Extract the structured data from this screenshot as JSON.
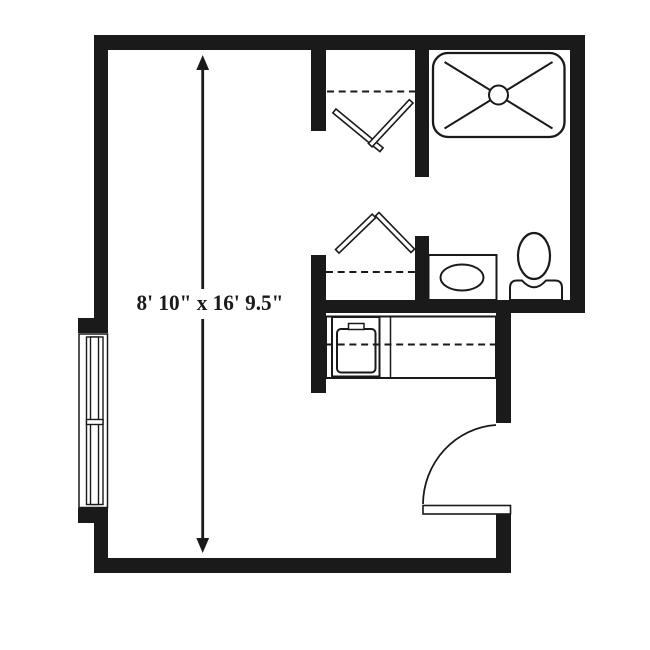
{
  "floor_plan": {
    "dimension_label": "8' 10\" x 16' 9.5\"",
    "colors": {
      "wall": "#1a1a1a",
      "line": "#1a1a1a",
      "background": "#ffffff"
    },
    "fixtures": [
      {
        "name": "shower",
        "symbol": "rounded-rect-with-x-and-drain"
      },
      {
        "name": "toilet",
        "symbol": "oval-bowl-with-tank"
      },
      {
        "name": "bathroom-sink-vanity",
        "symbol": "oval-in-rectangle"
      },
      {
        "name": "kitchen-sink",
        "symbol": "basin-with-faucet"
      },
      {
        "name": "kitchen-counter",
        "symbol": "counter-with-dashed-shelf-line"
      },
      {
        "name": "closet-rod-upper",
        "symbol": "v-chevron-with-dashed-shelf"
      },
      {
        "name": "closet-rod-lower",
        "symbol": "inverted-v-chevron-with-dashed-shelf"
      },
      {
        "name": "window",
        "symbol": "double-hung-window"
      },
      {
        "name": "entry-door",
        "symbol": "door-leaf-with-swing-arc"
      },
      {
        "name": "dimension-arrow",
        "symbol": "double-headed-vertical-arrow"
      }
    ]
  }
}
